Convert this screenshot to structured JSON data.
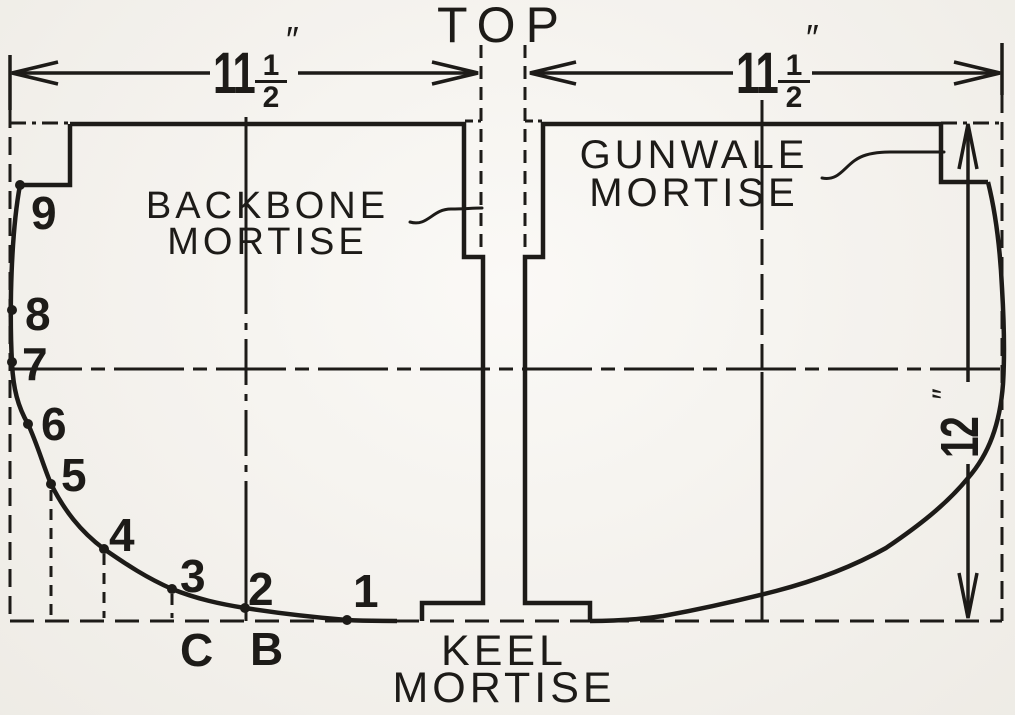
{
  "figure": {
    "top_label": "TOP",
    "backbone_label": {
      "line1": "BACKBONE",
      "line2": "MORTISE"
    },
    "gunwale_label": {
      "line1": "GUNWALE",
      "line2": "MORTISE"
    },
    "keel_label": {
      "line1": "KEEL",
      "line2": "MORTISE"
    },
    "dim_left": {
      "whole": "11",
      "frac_num": "1",
      "frac_den": "2",
      "unit": "″"
    },
    "dim_right": {
      "whole": "11",
      "frac_num": "1",
      "frac_den": "2",
      "unit": "″"
    },
    "dim_height": {
      "value": "12",
      "unit": "″"
    },
    "stations": [
      "9",
      "8",
      "7",
      "6",
      "5",
      "4",
      "3",
      "2",
      "1"
    ],
    "buttock_letters": [
      "C",
      "B"
    ],
    "colors": {
      "ink": "#1d1b18",
      "paper": "#f6f3ed"
    }
  }
}
